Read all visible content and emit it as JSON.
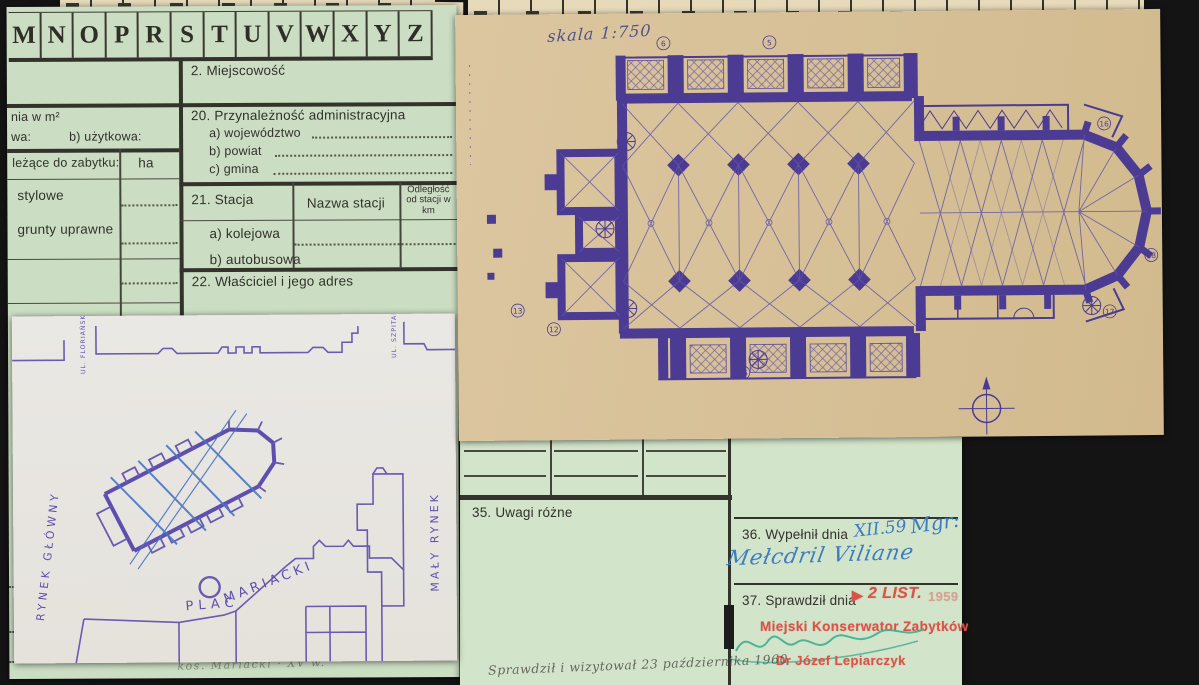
{
  "colors": {
    "background": "#141414",
    "paper_green": "#cbdec3",
    "paper_tan": "#d8c199",
    "paper_white": "#eae8e4",
    "ink_purple": "#4b3b92",
    "ink_blue": "#3c7cc0",
    "stamp_red": "#d95348",
    "ink_green": "#3fae91"
  },
  "card_index": {
    "letters": [
      "M",
      "N",
      "O",
      "P",
      "R",
      "S",
      "T",
      "U",
      "V",
      "W",
      "X",
      "Y",
      "Z"
    ]
  },
  "form_card": {
    "field2": "2. Miejscowość",
    "area_label": "nia w m²",
    "area_a": "wa:",
    "area_b": "b) użytkowa:",
    "belong_label": "leżące do zabytku:",
    "ha": "ha",
    "row_stylowe": "stylowe",
    "row_grunty": "grunty uprawne",
    "f20_title": "20. Przynależność administracyjna",
    "f20_a": "a) województwo",
    "f20_b": "b) powiat",
    "f20_c": "c) gmina",
    "f21_title": "21. Stacja",
    "f21_col_name": "Nazwa stacji",
    "f21_col_dist": "Odległość od stacji w km",
    "f21_row_a": "a) kolejowa",
    "f21_row_b": "b) autobusowa",
    "f22_title": "22. Właściciel i jego adres",
    "bottom_note": "koś. Mariacki · XV w."
  },
  "plan_sheet": {
    "scale_note": "skala 1:750",
    "annotations": [
      "5",
      "6",
      "13",
      "12",
      "15",
      "16",
      "17",
      "18"
    ]
  },
  "sketch_map": {
    "street_left": "UL. FLORIAŃSKA",
    "street_right": "UL. SZPITALNA",
    "square_left": "RYNEK GŁÓWNY",
    "square_right": "MAŁY RYNEK",
    "plac_word1": "PLAC",
    "plac_word2": "MARIACKI"
  },
  "form_card2": {
    "f35": "35. Uwagi różne",
    "f36": "36. Wypełnił dnia",
    "f36_entry_date": "XII.59",
    "f36_entry_title": "Mgr:",
    "f36_entry_name": "Mełcdril Viliane",
    "f37": "37. Sprawdził dnia",
    "stamp_arrow": "▶",
    "stamp_date": "2 LIST.",
    "stamp_year": "1959",
    "stamp_office": "Miejski Konserwator Zabytków",
    "stamp_person": "Dr Józef Lepiarczyk",
    "pencil_note": "Sprawdził i wizytował 23 października 1960"
  }
}
